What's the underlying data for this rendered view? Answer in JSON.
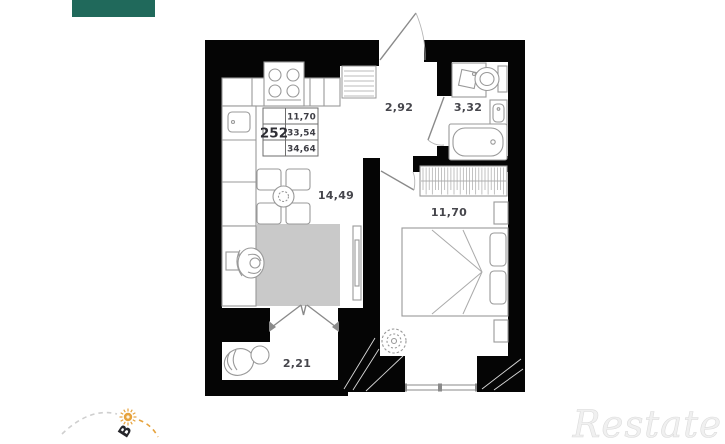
{
  "brand": {
    "logo_bar_color": "#20695b",
    "watermark": "Restate"
  },
  "info_box": {
    "apartment_number": "252",
    "rows": [
      "11,70",
      "33,54",
      "34,64"
    ]
  },
  "rooms": {
    "hall": {
      "area": "2,92"
    },
    "bathroom": {
      "area": "3,32"
    },
    "kitchen_living": {
      "area": "14,49"
    },
    "bedroom": {
      "area": "11,70"
    },
    "balcony": {
      "area": "2,21"
    }
  },
  "compass": {
    "direction_letter": "В",
    "sun_color": "#e6a23c",
    "west_arc_color": "#cfcfcf",
    "east_arc_color": "#e6a23c"
  },
  "colors": {
    "walls": "#000000",
    "furniture_lines": "#999999",
    "rug": "#c9c9c9",
    "labels": "#46464c",
    "watermark": "#f0f0f0"
  }
}
